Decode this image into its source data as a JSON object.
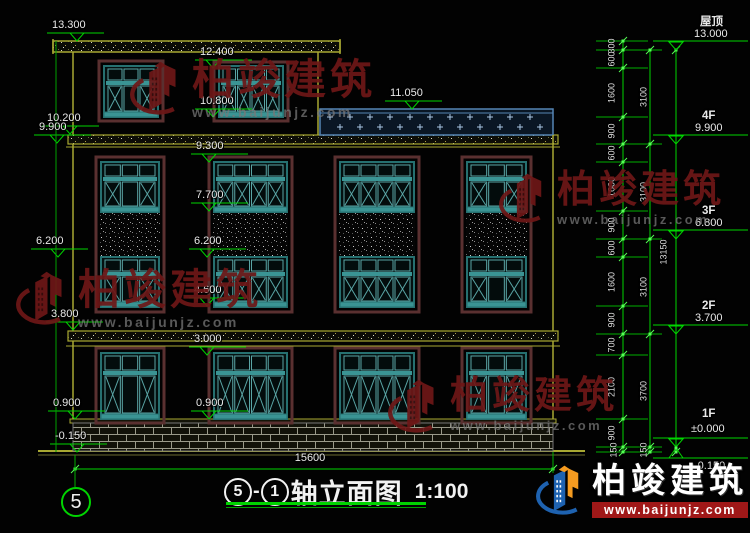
{
  "watermark": {
    "brand": "柏竣建筑",
    "url": "www.baijunjz.com"
  },
  "footer": {
    "brand": "柏竣建筑",
    "url": "www.baijunjz.com"
  },
  "title": {
    "axis_start": "5",
    "dash": "-",
    "axis_end": "1",
    "text": "轴立面图",
    "scale": "1:100"
  },
  "axis_bubble": "5",
  "dimensions": {
    "total_width": "15600",
    "chain_inner": [
      "300",
      "600",
      "1600",
      "900",
      "600",
      "1600",
      "900",
      "600",
      "1600",
      "900",
      "700",
      "2100",
      "900",
      "150"
    ],
    "chain_mid": [
      "3100",
      "3100",
      "3100",
      "3700",
      "150"
    ],
    "chain_total": "13150"
  },
  "elevation_markers": {
    "left": [
      "13.300",
      "10.200",
      "9.900",
      "6.200",
      "3.800",
      "0.900",
      "-0.150"
    ],
    "middle": [
      "12.400",
      "10.800",
      "11.050",
      "9.300",
      "7.700",
      "6.200",
      "4.600",
      "3.000",
      "0.900"
    ]
  },
  "floor_markers": [
    {
      "label": "屋顶",
      "elevation": "13.000"
    },
    {
      "label": "4F",
      "elevation": "9.900"
    },
    {
      "label": "3F",
      "elevation": "6.800"
    },
    {
      "label": "2F",
      "elevation": "3.700"
    },
    {
      "label": "1F",
      "elevation": "±0.000"
    },
    {
      "label": "",
      "elevation": "-0.150"
    }
  ],
  "colors": {
    "dimension": "#00d400",
    "wall": "#a8a832",
    "window_frame": "#267070",
    "railing": "#5585b5",
    "watermark": "#6e1717",
    "footer_bar": "#a01818",
    "logo_blue": "#1e62b0",
    "logo_orange": "#f59b20"
  }
}
